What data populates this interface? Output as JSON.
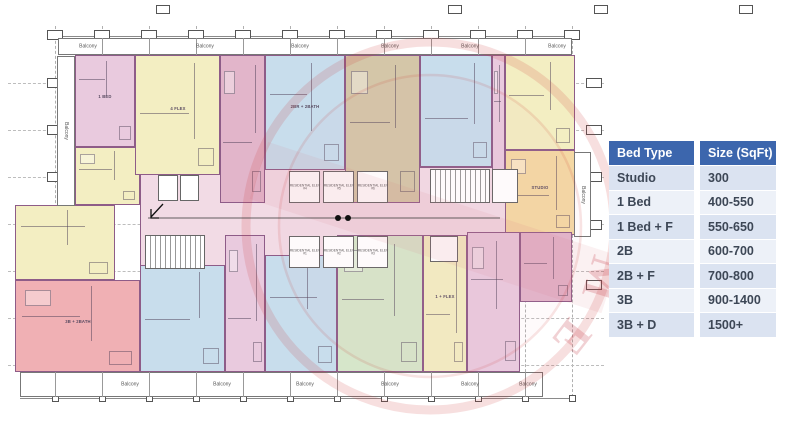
{
  "table": {
    "headers": [
      "Bed Type",
      "Size (SqFt)"
    ],
    "rows": [
      [
        "Studio",
        "300"
      ],
      [
        "1 Bed",
        "400-550"
      ],
      [
        "1 Bed + F",
        "550-650"
      ],
      [
        "2B",
        "600-700"
      ],
      [
        "2B + F",
        "700-800"
      ],
      [
        "3B",
        "900-1400"
      ],
      [
        "3B + D",
        "1500+"
      ]
    ],
    "colors": {
      "header_bg": "#3c66ad",
      "header_text": "#ffffff",
      "row_dark": "#dbe3f1",
      "row_light": "#edf1f8",
      "cell_text": "#3d4756"
    }
  },
  "plan": {
    "palette": {
      "pink": "#e9cade",
      "pinkDark": "#e2b5ca",
      "salmon": "#f0b0b4",
      "yellow": "#f3eec2",
      "tan": "#d4c6a8",
      "blue": "#c8ddec",
      "green": "#d6e6ca",
      "orange": "#f4d8a4",
      "corridor": "#f2dbe5",
      "wall": "#8e5c88",
      "watermark": "#c23340"
    },
    "grid": {
      "cols": [
        55,
        102,
        149,
        196,
        243,
        290,
        337,
        384,
        431,
        478,
        525,
        572
      ],
      "rows": [
        83,
        130,
        177,
        224,
        271,
        318,
        365
      ],
      "top_marks_y": 30,
      "upper_marks": [
        163,
        455,
        601,
        746
      ],
      "left_mark_rows": [
        83,
        130,
        177
      ],
      "right_mark_rows": [
        83,
        130,
        177,
        225,
        285
      ]
    },
    "core": {
      "x": 140,
      "y": 167,
      "w": 380,
      "h": 100
    },
    "units": [
      {
        "x": 75,
        "y": 55,
        "w": 60,
        "h": 92,
        "c": "pink",
        "label": "1 BED"
      },
      {
        "x": 75,
        "y": 147,
        "w": 65,
        "h": 58,
        "c": "yellow",
        "label": ""
      },
      {
        "x": 135,
        "y": 55,
        "w": 85,
        "h": 120,
        "c": "yellow",
        "label": "4 FLEX"
      },
      {
        "x": 220,
        "y": 55,
        "w": 45,
        "h": 148,
        "c": "pinkDark",
        "label": ""
      },
      {
        "x": 265,
        "y": 55,
        "w": 80,
        "h": 115,
        "c": "blue",
        "label": "2BR + 2BATH"
      },
      {
        "x": 345,
        "y": 55,
        "w": 75,
        "h": 148,
        "c": "tan",
        "label": ""
      },
      {
        "x": 420,
        "y": 55,
        "w": 72,
        "h": 112,
        "c": "blue",
        "label": ""
      },
      {
        "x": 492,
        "y": 55,
        "w": 13,
        "h": 148,
        "c": "pink",
        "label": ""
      },
      {
        "x": 505,
        "y": 55,
        "w": 70,
        "h": 95,
        "c": "yellow",
        "label": ""
      },
      {
        "x": 505,
        "y": 150,
        "w": 70,
        "h": 85,
        "c": "orange",
        "label": "STUDIO"
      },
      {
        "x": 15,
        "y": 205,
        "w": 100,
        "h": 75,
        "c": "yellow",
        "label": ""
      },
      {
        "x": 15,
        "y": 280,
        "w": 125,
        "h": 92,
        "c": "salmon",
        "label": "3B + 2BATH"
      },
      {
        "x": 140,
        "y": 265,
        "w": 85,
        "h": 107,
        "c": "blue",
        "label": ""
      },
      {
        "x": 225,
        "y": 235,
        "w": 40,
        "h": 137,
        "c": "pink",
        "label": ""
      },
      {
        "x": 265,
        "y": 255,
        "w": 72,
        "h": 117,
        "c": "blue",
        "label": ""
      },
      {
        "x": 337,
        "y": 235,
        "w": 86,
        "h": 137,
        "c": "green",
        "label": ""
      },
      {
        "x": 423,
        "y": 235,
        "w": 44,
        "h": 137,
        "c": "yellow",
        "label": "1 + FLEX"
      },
      {
        "x": 467,
        "y": 232,
        "w": 53,
        "h": 140,
        "c": "pink",
        "label": ""
      },
      {
        "x": 520,
        "y": 232,
        "w": 52,
        "h": 70,
        "c": "pinkDark",
        "label": ""
      }
    ],
    "stairs": [
      {
        "x": 145,
        "y": 235,
        "w": 60,
        "h": 34
      },
      {
        "x": 430,
        "y": 169,
        "w": 60,
        "h": 34
      }
    ],
    "utility_rooms": [
      {
        "x": 158,
        "y": 175,
        "w": 20,
        "h": 26
      },
      {
        "x": 180,
        "y": 175,
        "w": 19,
        "h": 26
      },
      {
        "x": 430,
        "y": 236,
        "w": 28,
        "h": 26
      },
      {
        "x": 492,
        "y": 169,
        "w": 26,
        "h": 34
      }
    ],
    "elevators": {
      "top_bank": {
        "x": 289,
        "y": 171,
        "shaft_w": 31,
        "shaft_h": 32,
        "gap": 3,
        "labels": [
          "RESIDENTIAL ELEV #4",
          "RESIDENTIAL ELEV #5",
          "RESIDENTIAL ELEV #6"
        ]
      },
      "bottom_bank": {
        "x": 289,
        "y": 236,
        "shaft_w": 31,
        "shaft_h": 32,
        "gap": 3,
        "labels": [
          "RESIDENTIAL ELEV #1",
          "RESIDENTIAL ELEV #2",
          "RESIDENTIAL ELEV #3"
        ]
      }
    },
    "balconies": {
      "label": "Balcony",
      "top_strip": {
        "x": 58,
        "y": 38,
        "w": 514,
        "h": 17
      },
      "bottom_strip": {
        "x": 20,
        "y": 372,
        "w": 523,
        "h": 25
      },
      "left_strip": {
        "x": 57,
        "y": 56,
        "w": 18,
        "h": 150
      },
      "right_strip": {
        "x": 574,
        "y": 152,
        "w": 17,
        "h": 85
      },
      "top_label_xs": [
        88,
        205,
        300,
        390,
        470,
        557
      ],
      "bottom_label_xs": [
        130,
        222,
        305,
        390,
        470,
        528
      ]
    },
    "watermark": {
      "letters": [
        "M",
        "E"
      ]
    }
  }
}
